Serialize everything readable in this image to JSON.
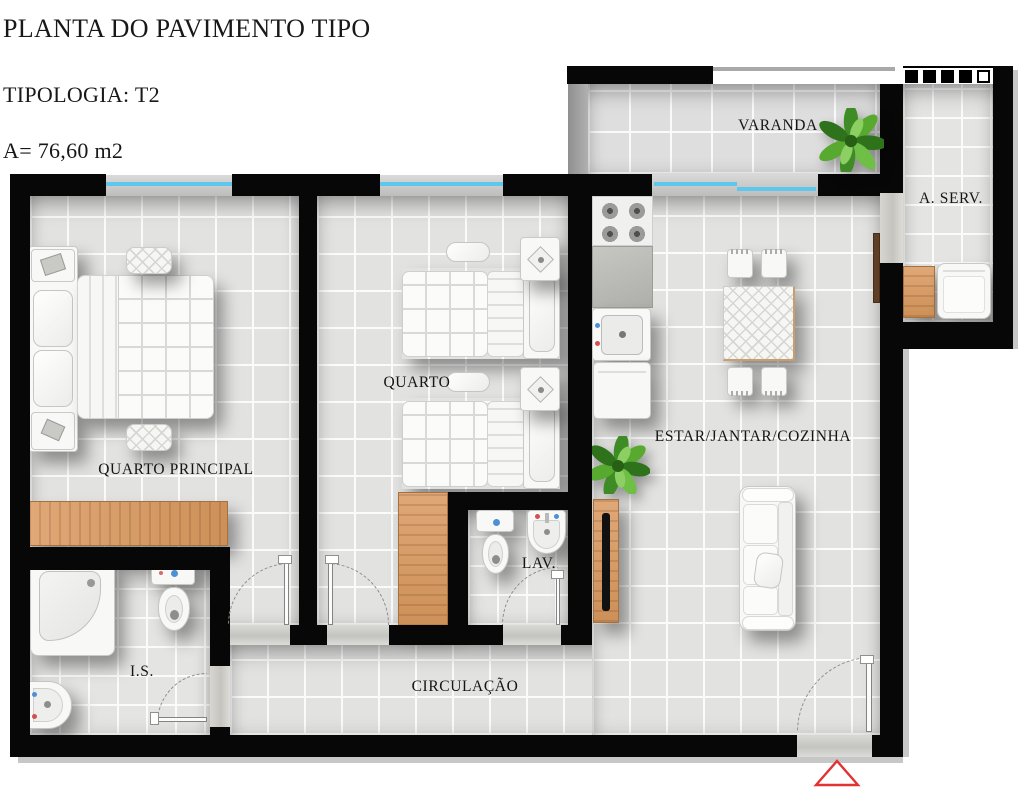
{
  "header": {
    "title": "PLANTA DO PAVIMENTO TIPO",
    "typology": "TIPOLOGIA: T2",
    "area": "A= 76,60 m2"
  },
  "plan": {
    "rooms": {
      "varanda": "VARANDA",
      "a_serv": "A. SERV.",
      "quarto_principal": "QUARTO PRINCIPAL",
      "quarto": "QUARTO",
      "estar_jantar_cozinha": "ESTAR/JANTAR/COZINHA",
      "lav": "LAV.",
      "is": "I.S.",
      "circulacao": "CIRCULAÇÃO"
    }
  },
  "colors": {
    "wall": "#070707",
    "window_glass": "#5ec7ee",
    "wood_light": "#d8a06e",
    "wood_dark": "#5f4026",
    "floor_tile": "#e2e2e1",
    "entrance_marker": "#e23333"
  }
}
